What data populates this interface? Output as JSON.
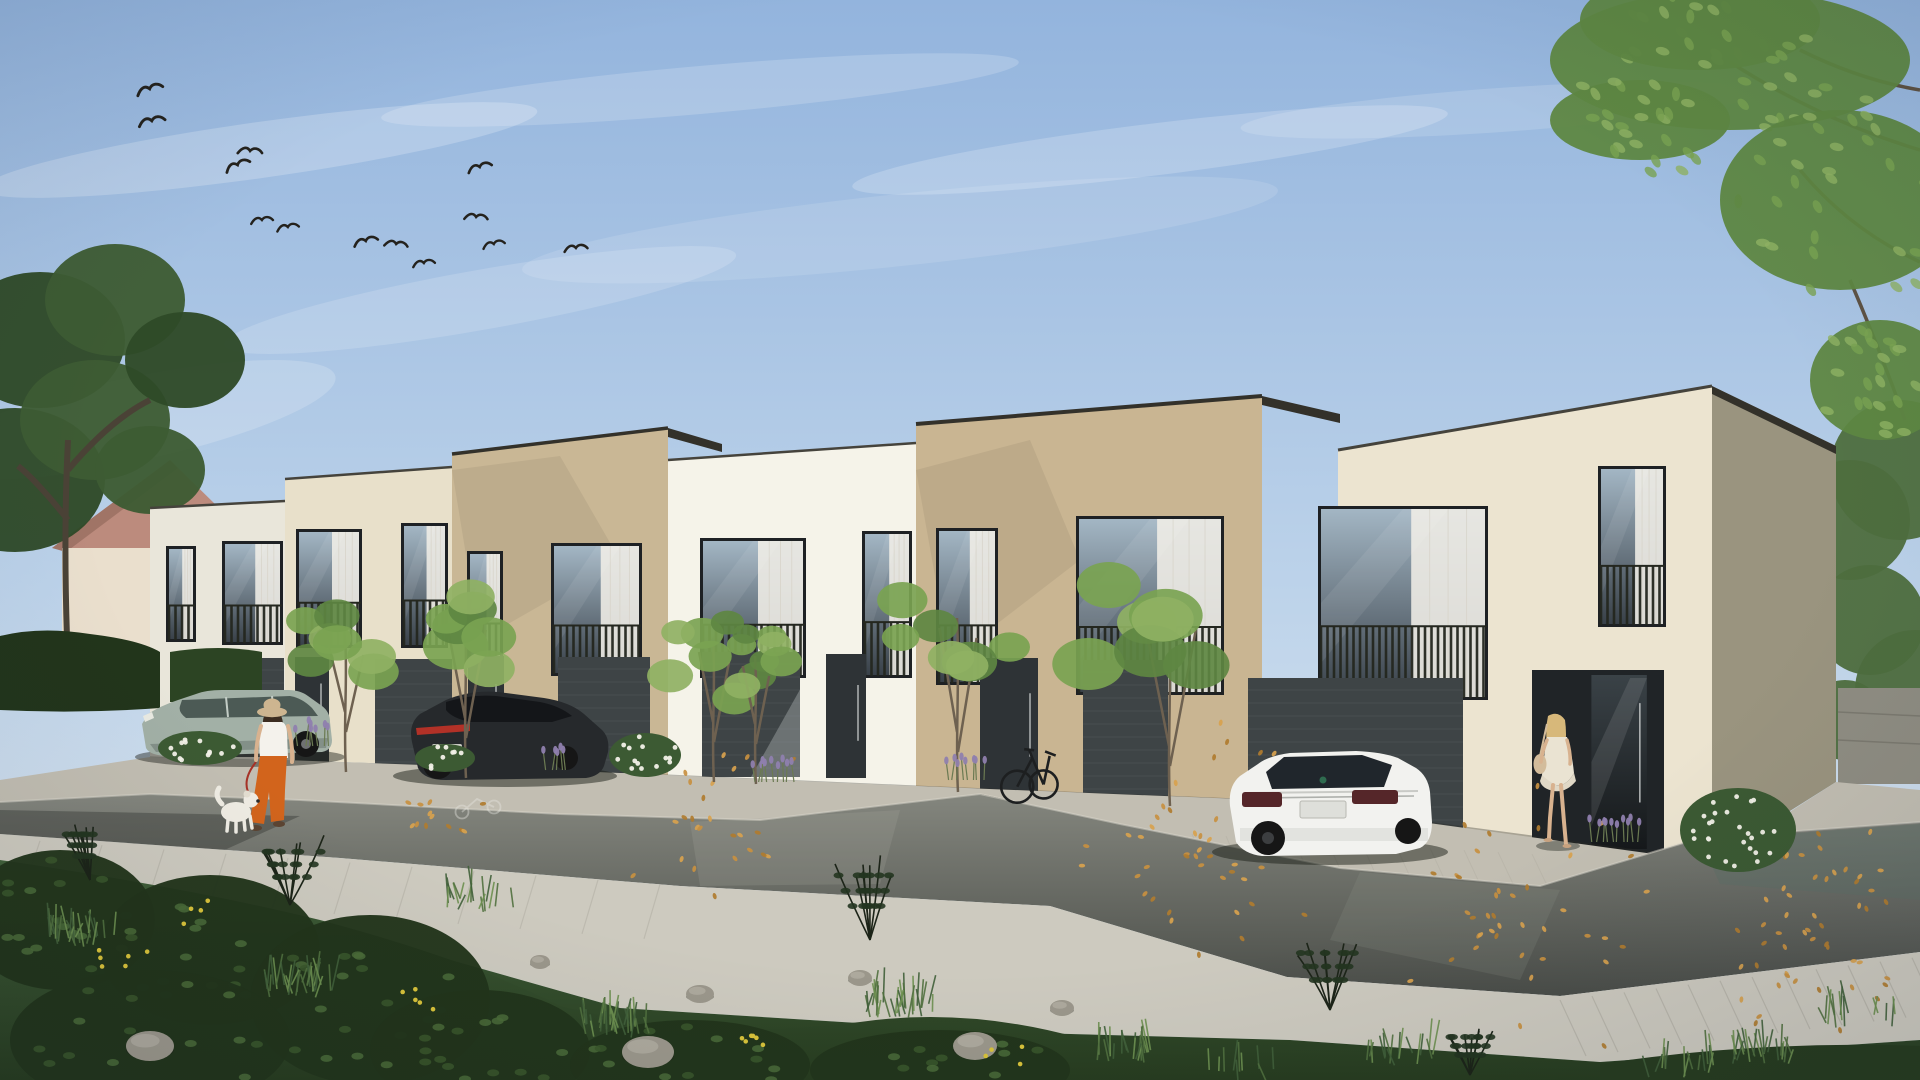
{
  "image_type": "architectural-rendering",
  "colors": {
    "sky_top": "#93b4dd",
    "sky_mid": "#bdd3ea",
    "sky_horizon": "#e4ecf2",
    "cloud": "#ffffff",
    "bird": "#24221d",
    "facade_b1": "#e9e6da",
    "facade_b2": "#e8e0ca",
    "facade_b3": "#c9b795",
    "facade_b4": "#f5f3e9",
    "facade_b5": "#c9b592",
    "facade_b6": "#ece4d0",
    "facade_b6_side": "#9a947f",
    "fascia": "#33312a",
    "parapet": "#45433c",
    "window_frame": "#1e2124",
    "glass_top": "#a3b6c4",
    "glass_bottom": "#394149",
    "curtain": "#edebe4",
    "railing": "#24271f",
    "garage": "#3e4446",
    "door": "#2e3336",
    "recess": "#202427",
    "door_glass": "#3a4247",
    "door_glass_dark": "#15181a",
    "pavers": "#c2beb2",
    "sidewalk": "#cdcabf",
    "joint": "#8e8b80",
    "road_top": "#84867e",
    "road_bottom": "#4a4d48",
    "road_teal": "#5e6f66",
    "curb": "#d9d6ca",
    "marking": "#e8e8e2",
    "grass_dark": "#273c1f",
    "grass_mid": "#41603a",
    "grass_light": "#6d9050",
    "bush": "#22351b",
    "tree_green_1": "#79a351",
    "tree_green_2": "#5e8742",
    "tree_green_3": "#8fb163",
    "trunk": "#6e6150",
    "treeline": "#4e6e3e",
    "pink_roof": "#bc8b7d",
    "pink_wall": "#eadfcd",
    "stone_wall": "#8f8d82",
    "leaf_1": "#c89040",
    "leaf_2": "#d8a24e",
    "leaf_3": "#b07c2f",
    "rock": "#9b978b",
    "dandelion": "#d9c33a",
    "flower_white": "#f2f1e8",
    "lavender_bloom": "#8f7fae",
    "lavender_stem": "#6b7a52",
    "volvo_body": "#a2b0a6",
    "volvo_dark": "#76837c",
    "volvo_glass": "#4c5a55",
    "bmw_body": "#26292c",
    "bmw_glass": "#141619",
    "tail_red": "#b23127",
    "skoda_body": "#f2f2ef",
    "skoda_shade": "#d7d8d4",
    "skoda_glass": "#20262c",
    "wheel": "#161616",
    "hub": "#6f7173",
    "skin": "#d8b28f",
    "hat": "#cdb590",
    "hair_brown": "#3c2d21",
    "top_white": "#f4f2ec",
    "pants_orange": "#d2641c",
    "hair_blonde": "#d7b87a",
    "dress": "#eae3d2",
    "bag": "#d3bc9b",
    "leash": "#a63227",
    "dog_body": "#efece3",
    "bike": "#1d1f20",
    "shadow": "#1c2018"
  },
  "scene": {
    "clouds": [
      {
        "x": 260,
        "y": 150,
        "rx": 280,
        "ry": 28,
        "rot": -8,
        "o": 0.22
      },
      {
        "x": 700,
        "y": 90,
        "rx": 320,
        "ry": 24,
        "rot": -5,
        "o": 0.18
      },
      {
        "x": 1150,
        "y": 150,
        "rx": 300,
        "ry": 26,
        "rot": -7,
        "o": 0.2
      },
      {
        "x": 480,
        "y": 300,
        "rx": 260,
        "ry": 30,
        "rot": -10,
        "o": 0.16
      },
      {
        "x": 900,
        "y": 230,
        "rx": 380,
        "ry": 36,
        "rot": -6,
        "o": 0.12
      },
      {
        "x": 1500,
        "y": 110,
        "rx": 260,
        "ry": 22,
        "rot": -4,
        "o": 0.15
      },
      {
        "x": 130,
        "y": 420,
        "rx": 210,
        "ry": 42,
        "rot": -12,
        "o": 0.18
      }
    ],
    "birds": [
      {
        "x": 150,
        "y": 90,
        "s": 1.2,
        "r": -15
      },
      {
        "x": 152,
        "y": 122,
        "s": 1.2,
        "r": -10
      },
      {
        "x": 250,
        "y": 152,
        "s": 1.1,
        "r": 5
      },
      {
        "x": 238,
        "y": 166,
        "s": 1.15,
        "r": -20
      },
      {
        "x": 262,
        "y": 221,
        "s": 1.0,
        "r": -5
      },
      {
        "x": 288,
        "y": 228,
        "s": 1.0,
        "r": -8
      },
      {
        "x": 366,
        "y": 242,
        "s": 1.1,
        "r": -12
      },
      {
        "x": 396,
        "y": 245,
        "s": 1.05,
        "r": 8
      },
      {
        "x": 424,
        "y": 264,
        "s": 1.0,
        "r": -6
      },
      {
        "x": 480,
        "y": 168,
        "s": 1.1,
        "r": -14
      },
      {
        "x": 476,
        "y": 218,
        "s": 1.05,
        "r": 6
      },
      {
        "x": 494,
        "y": 245,
        "s": 1.0,
        "r": -10
      },
      {
        "x": 576,
        "y": 249,
        "s": 1.05,
        "r": -4
      }
    ],
    "windows": [
      {
        "x": 166,
        "y": 546,
        "w": 30,
        "h": 96
      },
      {
        "x": 222,
        "y": 541,
        "w": 61,
        "h": 104
      },
      {
        "x": 296,
        "y": 529,
        "w": 66,
        "h": 119
      },
      {
        "x": 401,
        "y": 523,
        "w": 47,
        "h": 125
      },
      {
        "x": 467,
        "y": 551,
        "w": 36,
        "h": 117
      },
      {
        "x": 551,
        "y": 543,
        "w": 91,
        "h": 133
      },
      {
        "x": 700,
        "y": 538,
        "w": 106,
        "h": 140
      },
      {
        "x": 862,
        "y": 531,
        "w": 50,
        "h": 147
      },
      {
        "x": 936,
        "y": 528,
        "w": 62,
        "h": 157
      },
      {
        "x": 1076,
        "y": 516,
        "w": 148,
        "h": 179
      },
      {
        "x": 1318,
        "y": 506,
        "w": 170,
        "h": 194
      },
      {
        "x": 1598,
        "y": 466,
        "w": 68,
        "h": 161
      }
    ],
    "openings": [
      {
        "x": 205,
        "y": 658,
        "w": 79,
        "h": 99,
        "type": "garage"
      },
      {
        "x": 295,
        "y": 657,
        "w": 34,
        "h": 106,
        "type": "door"
      },
      {
        "x": 375,
        "y": 659,
        "w": 77,
        "h": 108,
        "type": "garage"
      },
      {
        "x": 468,
        "y": 656,
        "w": 36,
        "h": 112,
        "type": "door"
      },
      {
        "x": 558,
        "y": 657,
        "w": 92,
        "h": 116,
        "type": "garage"
      },
      {
        "x": 702,
        "y": 652,
        "w": 98,
        "h": 125,
        "type": "garage",
        "lit": true
      },
      {
        "x": 826,
        "y": 654,
        "w": 40,
        "h": 124,
        "type": "door"
      },
      {
        "x": 980,
        "y": 658,
        "w": 58,
        "h": 141,
        "type": "door"
      },
      {
        "x": 1083,
        "y": 660,
        "w": 85,
        "h": 145,
        "type": "garage"
      },
      {
        "x": 1248,
        "y": 678,
        "w": 215,
        "h": 177,
        "type": "garage"
      },
      {
        "x": 1532,
        "y": 670,
        "w": 132,
        "h": 184,
        "type": "recess"
      }
    ],
    "trees": [
      {
        "x": 346,
        "base": 772,
        "top": 585,
        "s": 58
      },
      {
        "x": 466,
        "base": 778,
        "top": 560,
        "s": 66
      },
      {
        "x": 714,
        "base": 782,
        "top": 592,
        "s": 50
      },
      {
        "x": 756,
        "base": 784,
        "top": 606,
        "s": 44
      },
      {
        "x": 958,
        "base": 792,
        "top": 568,
        "s": 62
      },
      {
        "x": 1170,
        "base": 806,
        "top": 560,
        "s": 86
      }
    ],
    "canopy": [
      {
        "x": 1730,
        "y": 60,
        "rx": 180,
        "ry": 70
      },
      {
        "x": 1840,
        "y": 200,
        "rx": 120,
        "ry": 90
      },
      {
        "x": 1700,
        "y": 20,
        "rx": 120,
        "ry": 50
      },
      {
        "x": 1880,
        "y": 380,
        "rx": 70,
        "ry": 60
      },
      {
        "x": 1640,
        "y": 120,
        "rx": 90,
        "ry": 40
      }
    ],
    "treeline_right": [
      {
        "x": 1850,
        "y": 520,
        "r": 60
      },
      {
        "x": 1900,
        "y": 470,
        "r": 70
      },
      {
        "x": 1870,
        "y": 620,
        "r": 55
      },
      {
        "x": 1915,
        "y": 690,
        "r": 60
      },
      {
        "x": 1845,
        "y": 720,
        "r": 40
      }
    ],
    "bg_trees_left": [
      {
        "x": 40,
        "y": 340,
        "r": 85
      },
      {
        "x": 115,
        "y": 300,
        "r": 70
      },
      {
        "x": 15,
        "y": 480,
        "r": 90
      },
      {
        "x": 95,
        "y": 420,
        "r": 75
      },
      {
        "x": 185,
        "y": 360,
        "r": 60
      },
      {
        "x": 150,
        "y": 470,
        "r": 55
      }
    ],
    "soft_bushes": [
      {
        "x": 60,
        "y": 920,
        "rx": 95,
        "ry": 70
      },
      {
        "x": 210,
        "y": 950,
        "rx": 110,
        "ry": 75
      },
      {
        "x": 370,
        "y": 1000,
        "rx": 120,
        "ry": 85
      },
      {
        "x": 150,
        "y": 1040,
        "rx": 140,
        "ry": 70
      },
      {
        "x": 480,
        "y": 1050,
        "rx": 110,
        "ry": 60
      },
      {
        "x": 690,
        "y": 1065,
        "rx": 120,
        "ry": 45
      },
      {
        "x": 940,
        "y": 1070,
        "rx": 130,
        "ry": 40
      }
    ],
    "twig_bushes": [
      {
        "x": 290,
        "y": 905,
        "s": 70
      },
      {
        "x": 870,
        "y": 940,
        "s": 85
      },
      {
        "x": 1330,
        "y": 1010,
        "s": 75
      },
      {
        "x": 90,
        "y": 880,
        "s": 60
      },
      {
        "x": 1470,
        "y": 1075,
        "s": 50
      }
    ],
    "tufts": [
      {
        "x": 80,
        "y": 940,
        "n": 26
      },
      {
        "x": 300,
        "y": 990,
        "n": 30
      },
      {
        "x": 620,
        "y": 1030,
        "n": 28
      },
      {
        "x": 900,
        "y": 1010,
        "n": 30
      },
      {
        "x": 1120,
        "y": 1056,
        "n": 20
      },
      {
        "x": 1400,
        "y": 1058,
        "n": 16
      },
      {
        "x": 1760,
        "y": 1056,
        "n": 22
      },
      {
        "x": 1860,
        "y": 1020,
        "n": 14
      },
      {
        "x": 480,
        "y": 905,
        "n": 18
      },
      {
        "x": 1240,
        "y": 1076,
        "n": 10
      },
      {
        "x": 1680,
        "y": 1072,
        "n": 14
      }
    ],
    "rocks": [
      {
        "x": 648,
        "y": 1052,
        "rx": 26,
        "ry": 16
      },
      {
        "x": 700,
        "y": 994,
        "rx": 14,
        "ry": 9
      },
      {
        "x": 860,
        "y": 978,
        "rx": 12,
        "ry": 8
      },
      {
        "x": 975,
        "y": 1046,
        "rx": 22,
        "ry": 14
      },
      {
        "x": 150,
        "y": 1046,
        "rx": 24,
        "ry": 15
      },
      {
        "x": 540,
        "y": 962,
        "rx": 10,
        "ry": 7
      },
      {
        "x": 1062,
        "y": 1008,
        "rx": 12,
        "ry": 8
      }
    ],
    "dandelions": [
      {
        "x": 120,
        "y": 960,
        "n": 6
      },
      {
        "x": 420,
        "y": 1000,
        "n": 5
      },
      {
        "x": 760,
        "y": 1040,
        "n": 6
      },
      {
        "x": 1010,
        "y": 1058,
        "n": 4
      },
      {
        "x": 210,
        "y": 912,
        "n": 4
      }
    ],
    "flower_bushes": [
      {
        "x": 200,
        "y": 748,
        "rx": 42,
        "ry": 17
      },
      {
        "x": 645,
        "y": 755,
        "rx": 36,
        "ry": 22
      },
      {
        "x": 1738,
        "y": 830,
        "rx": 58,
        "ry": 42
      },
      {
        "x": 445,
        "y": 758,
        "rx": 30,
        "ry": 14
      }
    ],
    "lavender": [
      {
        "x": 316,
        "y": 746,
        "w": 34
      },
      {
        "x": 775,
        "y": 782,
        "w": 44
      },
      {
        "x": 968,
        "y": 780,
        "w": 40
      },
      {
        "x": 1618,
        "y": 842,
        "w": 50
      },
      {
        "x": 560,
        "y": 770,
        "w": 26
      }
    ],
    "leaves": [
      {
        "x": 1190,
        "y": 860,
        "rx": 150,
        "ry": 14,
        "n": 42
      },
      {
        "x": 1520,
        "y": 930,
        "rx": 160,
        "ry": 40,
        "n": 40
      },
      {
        "x": 1790,
        "y": 950,
        "rx": 120,
        "ry": 50,
        "n": 36
      },
      {
        "x": 700,
        "y": 820,
        "rx": 120,
        "ry": 10,
        "n": 26
      },
      {
        "x": 430,
        "y": 808,
        "rx": 60,
        "ry": 8,
        "n": 12
      },
      {
        "x": 1850,
        "y": 870,
        "rx": 60,
        "ry": 26,
        "n": 14
      }
    ]
  }
}
